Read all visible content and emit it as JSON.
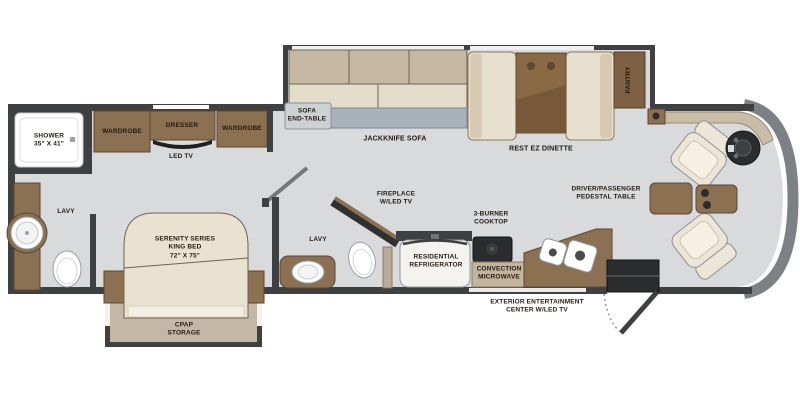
{
  "floorplan": {
    "title": "Class A motorhome floor plan",
    "labels": {
      "shower": "SHOWER\n35\" X 41\"",
      "wardrobe_left": "WARDROBE",
      "dresser": "DRESSER",
      "wardrobe_right": "WARDROBE",
      "led_tv": "LED TV",
      "lavy_rear": "LAVY",
      "king_bed": "SERENITY SERIES\nKING BED\n72\" X 75\"",
      "cpap_storage": "CPAP\nSTORAGE",
      "sofa_end_table": "SOFA\nEND-TABLE",
      "jackknife_sofa": "JACKKNIFE SOFA",
      "rest_ez_dinette": "REST EZ DINETTE",
      "pantry": "PANTRY",
      "lavy_mid": "LAVY",
      "fireplace": "FIREPLACE\nW/LED TV",
      "refrigerator": "RESIDENTIAL\nREFRIGERATOR",
      "cooktop": "3-BURNER\nCOOKTOP",
      "microwave": "CONVECTION\nMICROWAVE",
      "pedestal_table": "DRIVER/PASSENGER\nPEDESTAL TABLE",
      "exterior_entertainment": "EXTERIOR ENTERTAINMENT\nCENTER W/LED TV"
    },
    "colors": {
      "wall": "#3f4042",
      "floor": "#d8dadc",
      "wood": "#8c7052",
      "wood_dark": "#5c4733",
      "slideout_floor": "#c3b7a5",
      "bed_cream": "#e9e2d1",
      "sofa_back": "#c6b7a2",
      "sofa_seat": "#e4dcca",
      "sofa_front_strip": "#a9b2ba",
      "dinette_table": "#8a6a45",
      "appliance_dark": "#2b2c2e",
      "microwave_tan": "#c3b49e",
      "front_cap_gray": "#7d8186",
      "label_text": "#241a10"
    }
  }
}
